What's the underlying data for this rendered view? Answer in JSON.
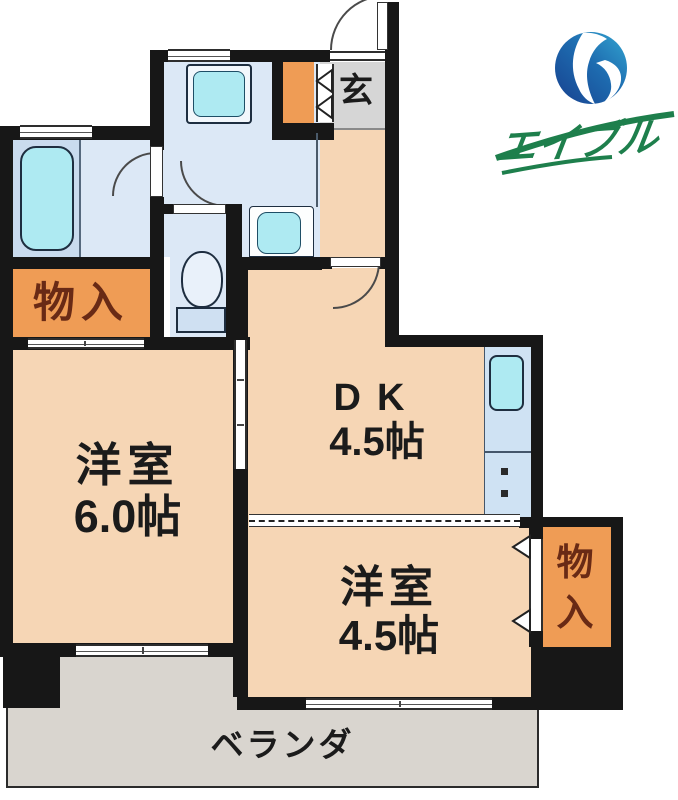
{
  "brand": {
    "name": "エイブル"
  },
  "floor_plan": {
    "entrance": {
      "label": "玄"
    },
    "storage_left": {
      "label": "物入"
    },
    "storage_right": {
      "label": "物入"
    },
    "dk": {
      "label": "DK",
      "size": "4.5帖"
    },
    "western_room_large": {
      "label": "洋室",
      "size": "6.0帖"
    },
    "western_room_small": {
      "label": "洋室",
      "size": "4.5帖"
    },
    "veranda": {
      "label": "ベランダ"
    }
  },
  "colors": {
    "room_peach": "#f6d6b5",
    "storage_orange": "#ef9c55",
    "wet_area_blue": "#dce8f6",
    "fixture_cyan": "#aeeaf2",
    "entrance_gray": "#d6d6d6",
    "veranda_gray": "#d9d5cf",
    "wall_black": "#171717",
    "storage_text_brown": "#692a15",
    "logo_blue_dark": "#17418f",
    "logo_blue_light": "#33a6d1",
    "logo_green": "#1e7f4c"
  }
}
